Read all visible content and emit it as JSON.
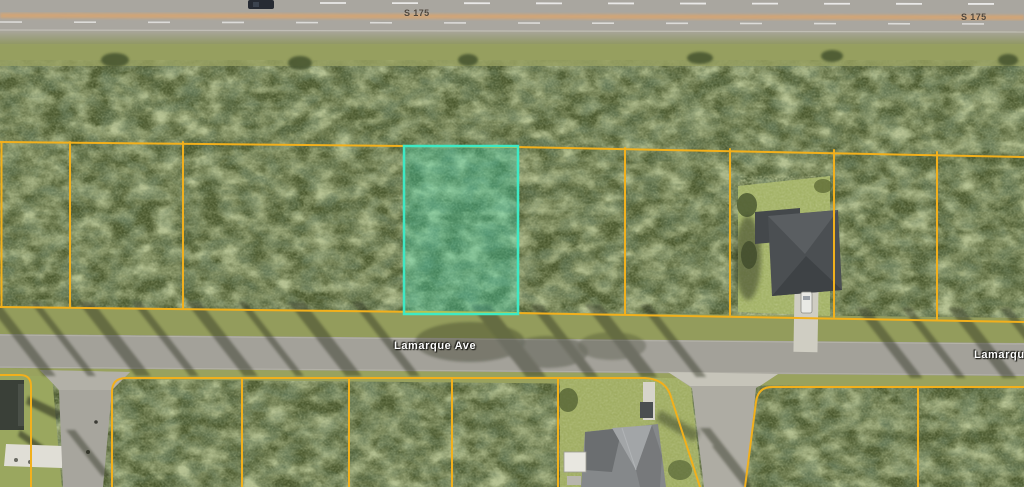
{
  "labels": {
    "highway_left": "S 175",
    "highway_right": "S 175",
    "street": "Lamarque Ave",
    "street_right_clipped": "Lamarque"
  },
  "colors": {
    "parcel_line": "#F2B01C",
    "highlight_stroke": "#3DE9C4",
    "highlight_fill": "rgba(61,233,196,0.30)",
    "street_label_color": "#FFFFFF",
    "highway_label_color": "#4E463C"
  }
}
